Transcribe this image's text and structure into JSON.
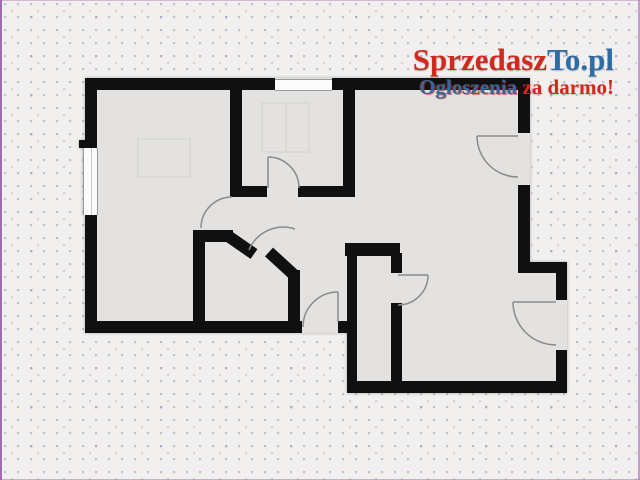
{
  "brand": {
    "name_part_red": "Sprzedasz",
    "name_part_blue": "To.pl",
    "tagline_word_blue": "Ogłoszenia",
    "tagline_rest": " za darmo!",
    "colors": {
      "name_red": "#cf2a1c",
      "name_blue": "#2e6ca4",
      "tagline_red": "#d6281a",
      "tagline_blue": "#33689c"
    }
  },
  "floorplan": {
    "wall_color": "#101010",
    "room_fill": "#e3e2e0",
    "door_arc_color": "#8a8a8a",
    "window_fill": "#fbfbfb",
    "background_color": "#f1f0ee",
    "edge_line_color": "#9d6cab",
    "window_count": 2,
    "door_count": 7
  }
}
